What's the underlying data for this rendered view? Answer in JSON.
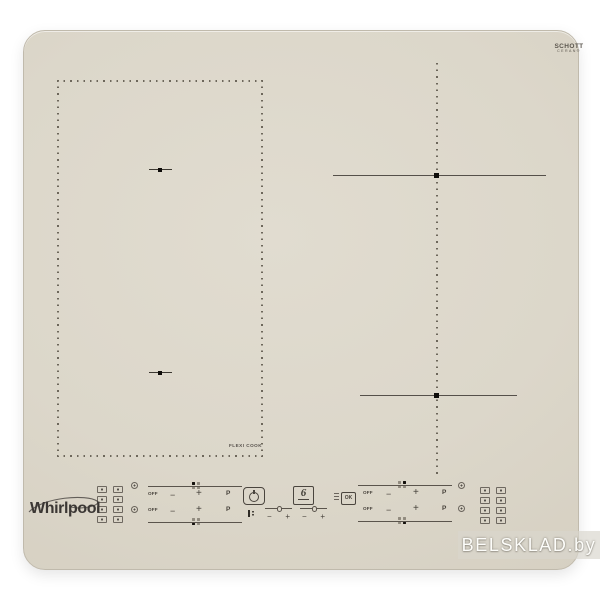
{
  "brand": {
    "logo": "Whirlpool"
  },
  "glass_maker": {
    "line1": "SCHOTT",
    "line2": "CERAN®"
  },
  "zones": {
    "flexi_label": "FLEXI COOK",
    "layout": "left flexi-cook dotted rectangle with 2 pan markers; two right cooking zones marked by crosshair lines"
  },
  "controls": {
    "slider": {
      "off": "OFF",
      "minus": "−",
      "plus": "+",
      "boost": "P"
    },
    "timer": {
      "minus": "−",
      "plus": "+"
    },
    "ok_label": "OK",
    "sense_logo": "6"
  },
  "icons": {
    "power": "power-button-icon",
    "key_lock": "key-lock-icon",
    "ok_hold": "ok-hold-microtext-icon",
    "zone_select": "zone-select-dot-icon",
    "pan_zone": "pan-zone-legend-icon"
  },
  "watermark": {
    "text": "BELSKLAD.by"
  },
  "colors": {
    "glass": "#dcd7ca",
    "ink": "#46413a",
    "marker_black": "#0f0d0a",
    "watermark_text": "#fdfdfa"
  }
}
